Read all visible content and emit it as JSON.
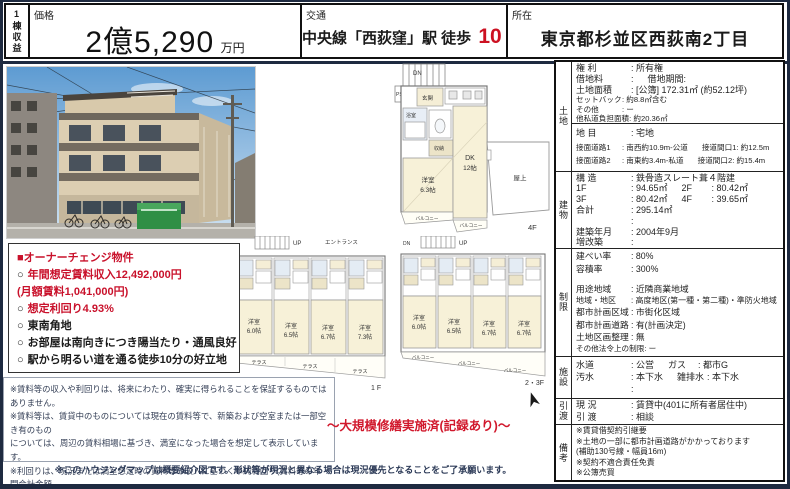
{
  "header": {
    "category_vertical": "1棟収益",
    "price_label": "価格",
    "price_value": "2億5,290",
    "price_unit": "万円",
    "access_label": "交通",
    "access_prefix": "中央線「西荻窪」駅 徒歩",
    "access_minutes": "10",
    "access_suffix": "分",
    "location_label": "所在",
    "location_value": "東京都杉並区西荻南2丁目"
  },
  "highlights": {
    "bullet": "○",
    "title": "■オーナーチェンジ物件",
    "items": [
      {
        "text": "年間想定賃料収入12,492,000円"
      },
      {
        "text": "(月額賃料1,041,000円)"
      },
      {
        "text": "想定利回り4.93%"
      },
      {
        "text": "東南角地"
      },
      {
        "text": "お部屋は南向きにつき陽当たり・通風良好"
      },
      {
        "text": "駅から明るい道を通る徒歩10分の好立地"
      }
    ]
  },
  "renovation_note": "～大規模修繕実施済(記録あり)～",
  "disclaimer": {
    "line1": "※賃料等の収入や利回りは、将来にわたり、確実に得られることを保証するものではありません。",
    "line2": "※賃料等は、賃貸中のものについては現在の賃料等で、新築および空室または一部空き有のもの",
    "line3": "については、周辺の賃料相場に基づき、満室になった場合を想定して表示しています。",
    "line4": "※利回りは、現況または満室想定時の賃料等の収入に基づく単純利回り(賃料等の年間合計金額",
    "line5": "÷購入価格×100)で、公租公課や維持管理費等の必要経費は控除されていません。"
  },
  "map_note": "※このハウジングマップは概要紹介図です。形状等が現況と異なる場合は現況優先となることをご了承願います。",
  "details": {
    "land": {
      "label": "土地",
      "rows": [
        {
          "l": "権 利",
          "v": ": 所有権"
        },
        {
          "l": "借地料",
          "v": ":",
          "l2": "借地期間",
          "v2": ":"
        },
        {
          "l": "土地面積",
          "v": ": [公簿]  172.31㎡  (約52.12坪)"
        },
        {
          "l": "セットバック",
          "v": ": 約8.8㎡含む"
        },
        {
          "l": "その他",
          "v": ": ー"
        },
        {
          "l": "他私道負担面積",
          "v": ": 約20.36㎡"
        },
        {
          "l": "地 目",
          "v": ": 宅地"
        },
        {
          "l": "接面道路1",
          "v": ": 南西約10.9m-公道",
          "l2": "接道間口1",
          "v2": ": 約12.5m"
        },
        {
          "l": "接面道路2",
          "v": ": 南東約3.4m-私道",
          "l2": "接道間口2",
          "v2": ": 約15.4m"
        }
      ]
    },
    "bldg": {
      "label": "建物",
      "rows": [
        {
          "l": "構 造",
          "v": ": 鉄骨造スレート葺４階建"
        },
        {
          "l": "1F",
          "v": ": 94.65㎡",
          "l2": "2F",
          "v2": ": 80.42㎡"
        },
        {
          "l": "3F",
          "v": ": 80.42㎡",
          "l2": "4F",
          "v2": ": 39.65㎡"
        },
        {
          "l": "合計",
          "v": ": 295.14㎡"
        },
        {
          "l": "",
          "v": ":"
        },
        {
          "l": "建築年月",
          "v": ": 2004年9月"
        },
        {
          "l": "増改築",
          "v": ":"
        },
        {
          "l": "間取り",
          "v": ": 1K×12、1DK×1"
        }
      ]
    },
    "limit": {
      "label": "制限",
      "rows": [
        {
          "l": "建ぺい率",
          "v": ": 80%"
        },
        {
          "l": "容積率",
          "v": ": 300%"
        },
        {
          "l": "用途地域",
          "v": ": 近隣商業地域"
        },
        {
          "l": "地域・地区",
          "v": ": 高度地区(第一種・第二種)・準防火地域"
        },
        {
          "l": "都市計画区域",
          "v": ": 市街化区域"
        },
        {
          "l": "都市計画道路",
          "v": ": 有(計画決定)"
        },
        {
          "l": "土地区画整理",
          "v": ": 無"
        },
        {
          "l": "その他法令上の制限",
          "v": ": ー"
        }
      ]
    },
    "fac": {
      "label": "施設",
      "rows": [
        {
          "l": "水道",
          "v": ": 公営",
          "l2": "ガス",
          "v2": ": 都市G"
        },
        {
          "l": "汚水",
          "v": ": 本下水",
          "l2": "雑排水",
          "v2": ": 本下水"
        },
        {
          "l": "",
          "v": ":"
        }
      ]
    },
    "hand": {
      "label": "引渡",
      "rows": [
        {
          "l": "現 況",
          "v": ": 賃貸中(401に所有者居住中)"
        },
        {
          "l": "引 渡",
          "v": ": 相談"
        }
      ]
    },
    "note": {
      "label": "備考",
      "lines": [
        "※賃貸借契約引継要",
        "※土地の一部に都市計画道路がかかっております",
        "(補助130号線・幅員16m)",
        "※契約不適合責任免責",
        "※公簿売買"
      ]
    }
  },
  "fp4": {
    "floor": "4F",
    "dn": "DN",
    "ps": "PS",
    "genkan": "玄関",
    "bath": "浴室",
    "storage": "収納",
    "roomword": "洋室",
    "roomsize": "6.3帖",
    "dk": "DK",
    "dksize": "12帖",
    "roof": "屋上",
    "balcony": "バルコニー"
  },
  "fp1": {
    "floor": "1 F",
    "up": "UP",
    "entrance": "エントランス",
    "ps": "PS",
    "roomword": "洋室",
    "sizes": [
      "6.0帖",
      "6.5帖",
      "6.7帖",
      "7.3帖"
    ],
    "terrace": "テラス"
  },
  "fp23": {
    "floor": "2・3F",
    "up": "UP",
    "dn": "DN",
    "ps": "PS",
    "roomword": "洋室",
    "sizes": [
      "6.0帖",
      "6.5帖",
      "6.7帖",
      "6.7帖"
    ],
    "balcony": "バルコニー"
  }
}
